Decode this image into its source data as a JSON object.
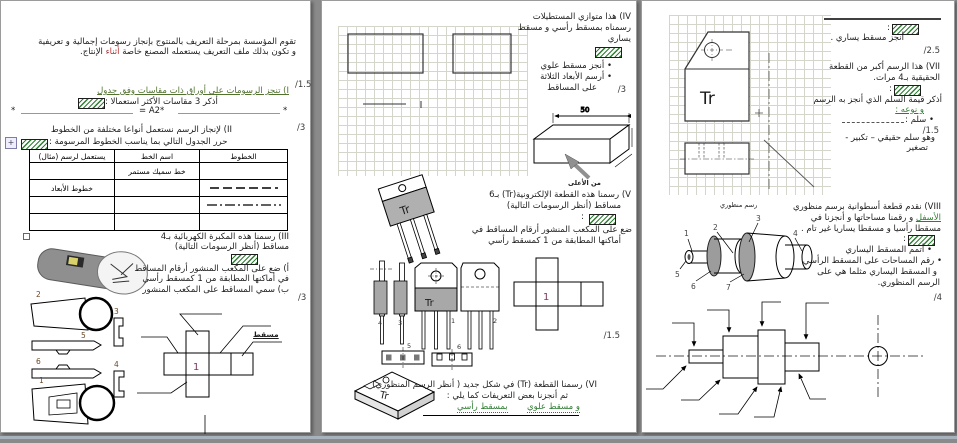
{
  "symbols": {
    "colon": ":",
    "star": "*",
    "move_handle": "+"
  },
  "page1": {
    "intro_a": "تقوم المؤسسة بمرحلة التعريف بالمنتوج بإنجاز رسومات إجمالية و تعريفية و تكون بذلك ملف التعريف يستعمله المصنع خاصة",
    "intro_hl": "أثناء",
    "intro_b": "الإنتاج.",
    "mark_q1": "/1.5",
    "mark_q2": "/3",
    "mark_q3": "/3",
    "q1_title": "I) تنجز الرسومات على أوراق ذات مقاسات وفق جدول",
    "q1_prompt": "أذكر 3 مقاسات الأكثر استعمالا :",
    "q1_answer": "= A2*",
    "q2_title": "II) لإنجاز الرسم نستعمل أنواعا مختلفة من الخطوط",
    "q2_prompt": "حرر الجدول التالي بما يناسب الخطوط المرسومة :",
    "table": {
      "col_lines": "الخطوط",
      "col_name": "اسم الخط",
      "col_use": "يستعمل لرسم (مثال)",
      "row1_name": "خط سميك مستمر",
      "row2_use": "خطوط الأبعاد"
    },
    "q3_line1": "III) رسمنا هذه المكبرة الكهربائية بـ4",
    "q3_line2": "مساقط (أنظر الرسومات التالية)",
    "q3_item_a1": "أ) ضع على المكعب المنشور أرقام المساقط",
    "q3_item_a2": "في أماكنها المطابقة من 1 كمسقط رأسي",
    "q3_item_b": "ب) سمي المساقط على المكعب المنشور",
    "view1": "1",
    "view2": "2",
    "view3": "3",
    "view4": "4",
    "view5": "5",
    "view6": "6",
    "cube_center": "1",
    "cube_label": "مسقط"
  },
  "page2": {
    "mark_q4": "/3",
    "mark_q5": "/1.5",
    "q4_line1": "IV) هذا متوازي المستطيلات",
    "q4_line2": "رسمناه بمسقط رأسي و مسقط",
    "q4_line3": "يساري",
    "q4_b1": "• أنجز مسقط علوي",
    "q4_b2": "• أرسم الأبعاد الثلاثة",
    "q4_b3": "على المساقط",
    "box_dim": "50",
    "box_arrow_label": "من الأعلى",
    "q5_line1": "V) رسمنا هذه القطعة الإلكترونية(Tr) بـ6",
    "q5_line2": "مساقط (أنظر الرسومات التالية)",
    "q5_line3": "ضع على المكعب المنشور أرقام المساقط في",
    "q5_line4": "أماكنها المطابقة من 1 كمسقط رأسي",
    "tr": "Tr",
    "view1": "1",
    "view2": "2",
    "view3": "3",
    "view4": "4",
    "view5": "5",
    "view6": "6",
    "cube_center": "1",
    "q6_line1": "VI) رسمنا القطعة (Tr) في شكل جديد ( أنظر الرسم المنظوري)",
    "q6_line2": "ثم أنجزنا بعض التعريفات كما يلي :",
    "q6_part1": "بمسقط رأسي",
    "q6_part2": "و مسقط علوي"
  },
  "page3": {
    "mark_q7a": "/2.5",
    "mark_q7b": "/1.5",
    "mark_q8": "/4",
    "l1": "أنجز مسقط يساري .",
    "q7_line1": "VII) هذا الرسم أكبر من القطعة",
    "q7_line2": "الحقيقية بـ4 مرات.",
    "q7_line3": "أذكر قيمة السلم الذي أنجز به الرسم",
    "q7_line4": "و نوعه :",
    "q7_scale": "• سلم :",
    "q7_line5": "وهو سلم حقيقي – تكبير -",
    "q7_line6": "تصغير",
    "tr": "Tr",
    "persp_caption": "رسم منظوري",
    "q8_line1": "VIII) نقدم قطعة أسطوانية برسم منظوري",
    "q8_line2a": "و رقمنا مساحاتها و أنجزنا في",
    "q8_line2hl": "الأسفل",
    "q8_line3": "مسقطا رأسيا و مسقطا يساريا غير تام .",
    "q8_b1": "• أتمم المسقط اليساري",
    "q8_b2": "• رقم المساحات على المسقط الرأسي",
    "q8_b3": "و المسقط اليساري مثلما هي على",
    "q8_b4": "الرسم المنظوري.",
    "n1": "1",
    "n2": "2",
    "n3": "3",
    "n4": "4",
    "n5": "5",
    "n6": "6",
    "n7": "7"
  }
}
